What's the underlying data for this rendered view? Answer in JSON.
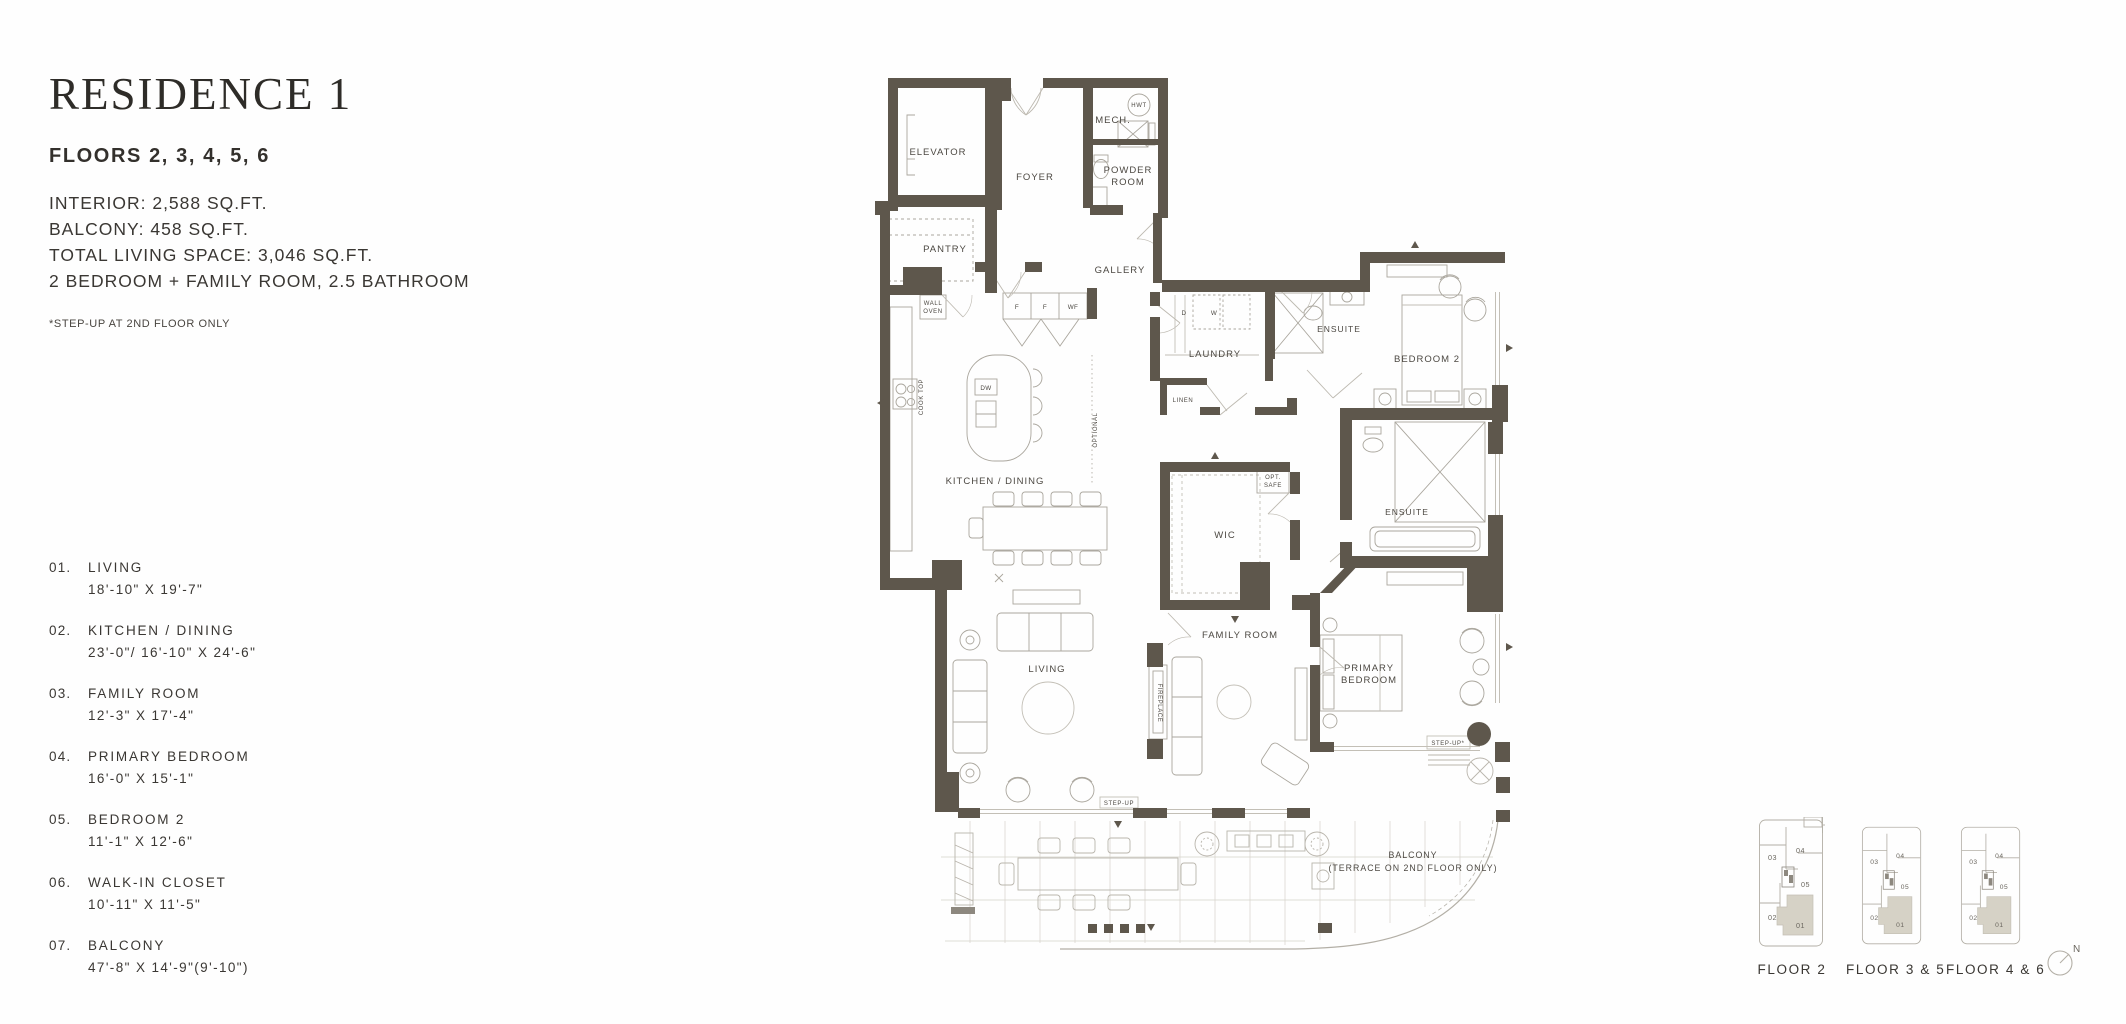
{
  "document": {
    "title": "RESIDENCE 1",
    "floors_heading": "FLOORS 2, 3, 4, 5, 6",
    "stats": [
      "INTERIOR: 2,588 SQ.FT.",
      "BALCONY: 458 SQ.FT.",
      "TOTAL LIVING SPACE: 3,046 SQ.FT.",
      "2 BEDROOM + FAMILY ROOM, 2.5 BATHROOM"
    ],
    "footnote": "*STEP-UP AT 2ND FLOOR ONLY"
  },
  "legend": {
    "items": [
      {
        "num": "01.",
        "name": "LIVING",
        "dims": "18'-10\" X 19'-7\""
      },
      {
        "num": "02.",
        "name": "KITCHEN / DINING",
        "dims": "23'-0\"/ 16'-10\" X 24'-6\""
      },
      {
        "num": "03.",
        "name": "FAMILY ROOM",
        "dims": "12'-3\" X 17'-4\""
      },
      {
        "num": "04.",
        "name": "PRIMARY BEDROOM",
        "dims": "16'-0\" X 15'-1\""
      },
      {
        "num": "05.",
        "name": "BEDROOM 2",
        "dims": "11'-1\" X 12'-6\""
      },
      {
        "num": "06.",
        "name": "WALK-IN CLOSET",
        "dims": "10'-11\" X 11'-5\""
      },
      {
        "num": "07.",
        "name": "BALCONY",
        "dims": "47'-8\" X 14'-9\"(9'-10\")"
      }
    ]
  },
  "plan": {
    "labels": {
      "elevator": "ELEVATOR",
      "foyer": "FOYER",
      "mech": "MECH.",
      "hwt": "HWT",
      "powder1": "POWDER",
      "powder2": "ROOM",
      "pantry": "PANTRY",
      "gallery": "GALLERY",
      "wall_oven1": "WALL",
      "wall_oven2": "OVEN",
      "f1": "F",
      "f2": "F",
      "wf": "WF",
      "cook_top": "COOK TOP",
      "dw": "DW",
      "kitchen_dining": "KITCHEN / DINING",
      "optional": "OPTIONAL",
      "laundry": "LAUNDRY",
      "d": "D",
      "w": "W",
      "linen": "LINEN",
      "ensuite2": "ENSUITE",
      "bedroom2": "BEDROOM 2",
      "opt_safe1": "OPT.",
      "opt_safe2": "SAFE",
      "wic": "WIC",
      "ensuite_primary": "ENSUITE",
      "living": "LIVING",
      "fireplace": "FIREPLACE",
      "family_room": "FAMILY ROOM",
      "primary1": "PRIMARY",
      "primary2": "BEDROOM",
      "step_up": "STEP-UP",
      "step_up_star": "STEP-UP*",
      "balcony1": "BALCONY",
      "balcony2": "(TERRACE ON 2ND FLOOR ONLY)"
    }
  },
  "keyplans": {
    "floors": [
      {
        "label": "FLOOR 2"
      },
      {
        "label": "FLOOR 3 & 5"
      },
      {
        "label": "FLOOR 4 & 6"
      }
    ],
    "units": {
      "u01": "01",
      "u02": "02",
      "u03": "03",
      "u04": "04",
      "u05": "05"
    },
    "compass_north": "N"
  },
  "colors": {
    "wall": "#5e574c",
    "furniture_line": "#aaa69d",
    "balcony_line": "#c9c6bd",
    "text": "#37342f",
    "plan_text": "#4c4842",
    "keyplan_shade": "#d6d2c6"
  }
}
